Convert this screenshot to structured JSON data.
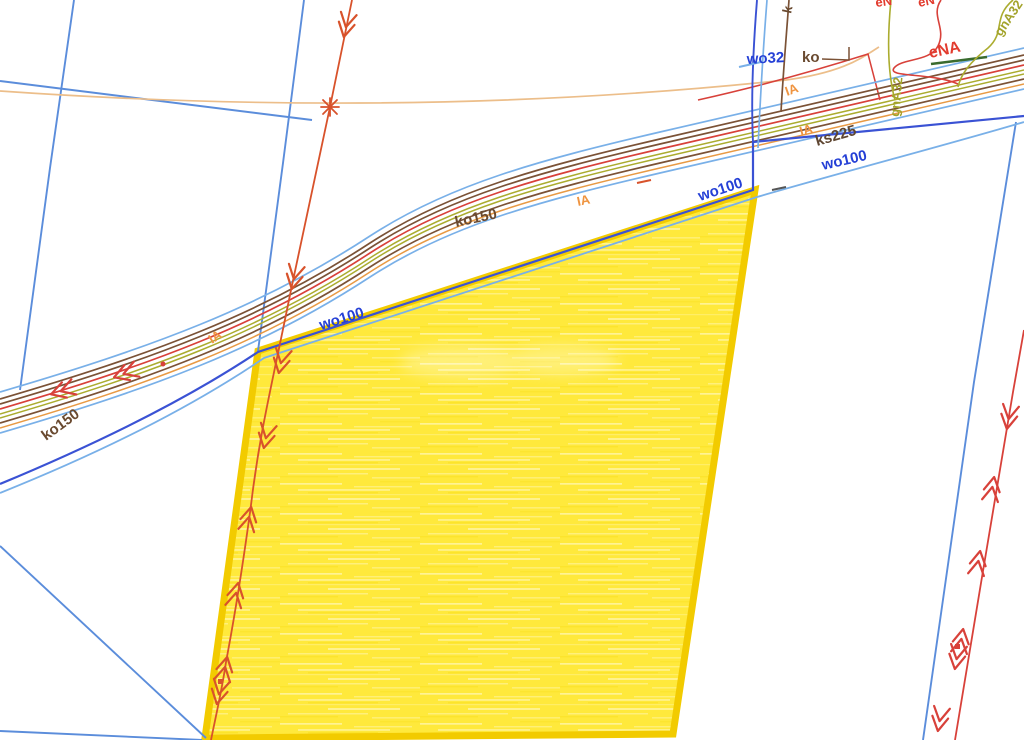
{
  "map": {
    "labels": [
      {
        "text": "ko150",
        "color": "#6a4a30"
      },
      {
        "text": "ko150",
        "color": "#6a4a30"
      },
      {
        "text": "IA",
        "color": "#ef9440"
      },
      {
        "text": "IA",
        "color": "#ef9440"
      },
      {
        "text": "IA",
        "color": "#ef9440"
      },
      {
        "text": "IA",
        "color": "#ef9440"
      },
      {
        "text": "wo100",
        "color": "#2540d6"
      },
      {
        "text": "wo100",
        "color": "#2540d6"
      },
      {
        "text": "wo100",
        "color": "#2540d6"
      },
      {
        "text": "ks225",
        "color": "#5f4632"
      },
      {
        "text": "wo32",
        "color": "#2540d6"
      },
      {
        "text": "ko",
        "color": "#6a4a30"
      },
      {
        "text": "eNA",
        "color": "#e23b2e"
      },
      {
        "text": "gnA32",
        "color": "#a3a32b"
      },
      {
        "text": "gnA32",
        "color": "#a3a32b"
      },
      {
        "text": "k",
        "color": "#6a4a30"
      },
      {
        "text": "eN",
        "color": "#e23b2e"
      },
      {
        "text": "eN",
        "color": "#e23b2e"
      }
    ],
    "palette": {
      "parcel_fill": "#ffe93c",
      "parcel_border": "#f2cb00",
      "water_main_blue": "#3a52d4",
      "light_blue": "#79b0e8",
      "boundary_blue": "#5b8ddb",
      "sewer_brown": "#7b5236",
      "power_red": "#d8413a",
      "drain_red_orange": "#d8522b",
      "gas_olive": "#abac2f",
      "overhead_orange": "#e89a45",
      "tan_line": "#ecbe8a",
      "cable_dark_green": "#3a6b2e"
    },
    "icons": {
      "flow-arrow-icon": "nested chevron",
      "junction-star-icon": "asterisk cross",
      "junction-node-icon": "small square"
    }
  }
}
